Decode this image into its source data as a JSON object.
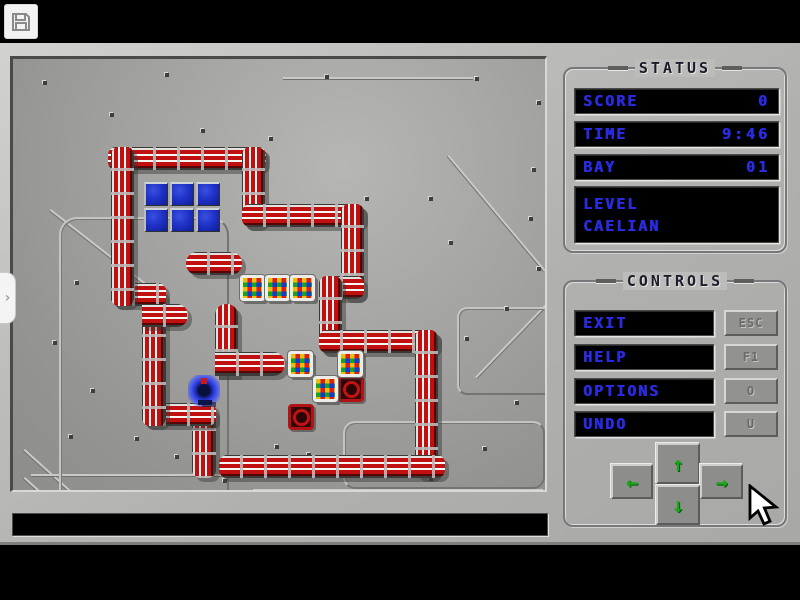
{
  "window": {
    "toolbar": {
      "save_button": "save"
    },
    "left_tab": {
      "glyph": "›"
    }
  },
  "message_bar": {
    "text": ""
  },
  "status_panel": {
    "title": "STATUS",
    "rows": [
      {
        "label": "SCORE",
        "value": "0"
      },
      {
        "label": "TIME",
        "value": "9:46"
      },
      {
        "label": "BAY",
        "value": "01"
      }
    ],
    "level": {
      "label": "LEVEL",
      "value": "CAELIAN"
    }
  },
  "controls_panel": {
    "title": "CONTROLS",
    "buttons": [
      {
        "label": "EXIT",
        "key": "ESC"
      },
      {
        "label": "HELP",
        "key": "F1"
      },
      {
        "label": "OPTIONS",
        "key": "O"
      },
      {
        "label": "UNDO",
        "key": "U"
      }
    ]
  },
  "dpad": {
    "up": "↑",
    "down": "↓",
    "left": "←",
    "right": "→"
  },
  "colors": {
    "lcd_blue": "#2a2ae0",
    "wall_red": "#c01010",
    "arrow_green": "#16a816",
    "floor_gray": "#9a9a98",
    "panel_gray": "#bcbcba"
  },
  "cursor": {
    "x": 748,
    "y": 484
  },
  "game": {
    "walls": [
      {
        "o": "h",
        "x": 95,
        "y": 88,
        "w": 158,
        "h": 23
      },
      {
        "o": "v",
        "x": 229,
        "y": 88,
        "w": 23,
        "h": 80
      },
      {
        "o": "h",
        "x": 229,
        "y": 145,
        "w": 122,
        "h": 23
      },
      {
        "o": "v",
        "x": 328,
        "y": 145,
        "w": 23,
        "h": 95
      },
      {
        "o": "h",
        "x": 306,
        "y": 217,
        "w": 45,
        "h": 23
      },
      {
        "o": "v",
        "x": 306,
        "y": 217,
        "w": 23,
        "h": 77
      },
      {
        "o": "h",
        "x": 306,
        "y": 271,
        "w": 119,
        "h": 23
      },
      {
        "o": "v",
        "x": 402,
        "y": 271,
        "w": 23,
        "h": 148
      },
      {
        "o": "h",
        "x": 206,
        "y": 396,
        "w": 226,
        "h": 23
      },
      {
        "o": "v",
        "x": 179,
        "y": 348,
        "w": 24,
        "h": 71
      },
      {
        "o": "h",
        "x": 129,
        "y": 344,
        "w": 74,
        "h": 23
      },
      {
        "o": "v",
        "x": 129,
        "y": 230,
        "w": 24,
        "h": 137
      },
      {
        "o": "h",
        "x": 98,
        "y": 224,
        "w": 55,
        "h": 23
      },
      {
        "o": "v",
        "x": 98,
        "y": 88,
        "w": 23,
        "h": 159
      },
      {
        "o": "h",
        "x": 173,
        "y": 193,
        "w": 56,
        "h": 23,
        "r": "11px"
      },
      {
        "o": "h",
        "x": 129,
        "y": 245,
        "w": 46,
        "h": 23,
        "r": "0 11px 11px 0"
      },
      {
        "o": "v",
        "x": 202,
        "y": 245,
        "w": 23,
        "h": 72,
        "r": "11px 11px 0 0"
      },
      {
        "o": "h",
        "x": 202,
        "y": 293,
        "w": 70,
        "h": 24,
        "r": "0 12px 12px 0"
      }
    ],
    "blue_grid": {
      "x": 131,
      "y": 123,
      "cols": 3,
      "rows": 2,
      "size": 24,
      "gap": 2
    },
    "boxes": [
      {
        "x": 227,
        "y": 216
      },
      {
        "x": 252,
        "y": 216
      },
      {
        "x": 277,
        "y": 216
      },
      {
        "x": 275,
        "y": 292
      },
      {
        "x": 325,
        "y": 292
      },
      {
        "x": 300,
        "y": 317
      }
    ],
    "pads": [
      {
        "x": 325,
        "y": 317
      },
      {
        "x": 275,
        "y": 345
      }
    ],
    "player": {
      "x": 175,
      "y": 316
    },
    "decor": [
      {
        "line": true,
        "x": 38,
        "y": 150,
        "len": 120,
        "angle": 38
      },
      {
        "line": true,
        "x": 12,
        "y": 390,
        "len": 150,
        "angle": 42
      },
      {
        "line": true,
        "x": 12,
        "y": 418,
        "len": 172,
        "angle": 42
      },
      {
        "line": true,
        "x": 436,
        "y": 96,
        "len": 150,
        "angle": 50
      },
      {
        "line": true,
        "x": 462,
        "y": 318,
        "len": 130,
        "angle": -46
      },
      {
        "line": true,
        "x": 240,
        "y": 430,
        "len": 290,
        "angle": 0
      },
      {
        "line": true,
        "x": 18,
        "y": 415,
        "len": 200,
        "angle": 0
      },
      {
        "line": true,
        "x": 270,
        "y": 18,
        "len": 190,
        "angle": 0
      },
      {
        "x": 46,
        "y": 158,
        "w": 170,
        "h": 296,
        "rr": 18
      },
      {
        "x": 330,
        "y": 362,
        "w": 202,
        "h": 68,
        "rr": 12
      },
      {
        "x": 444,
        "y": 248,
        "w": 96,
        "h": 88,
        "rr": 10
      }
    ],
    "rivets": [
      [
        30,
        22
      ],
      [
        152,
        14
      ],
      [
        312,
        16
      ],
      [
        462,
        18
      ],
      [
        97,
        54
      ],
      [
        188,
        70
      ],
      [
        256,
        78
      ],
      [
        524,
        42
      ],
      [
        519,
        109
      ],
      [
        62,
        222
      ],
      [
        40,
        282
      ],
      [
        78,
        330
      ],
      [
        56,
        376
      ],
      [
        122,
        378
      ],
      [
        162,
        396
      ],
      [
        262,
        386
      ],
      [
        350,
        402
      ],
      [
        416,
        418
      ],
      [
        470,
        388
      ],
      [
        502,
        342
      ],
      [
        352,
        288
      ],
      [
        452,
        278
      ],
      [
        492,
        248
      ],
      [
        524,
        208
      ],
      [
        436,
        182
      ],
      [
        516,
        158
      ],
      [
        352,
        138
      ],
      [
        416,
        138
      ],
      [
        294,
        394
      ],
      [
        210,
        420
      ]
    ]
  }
}
